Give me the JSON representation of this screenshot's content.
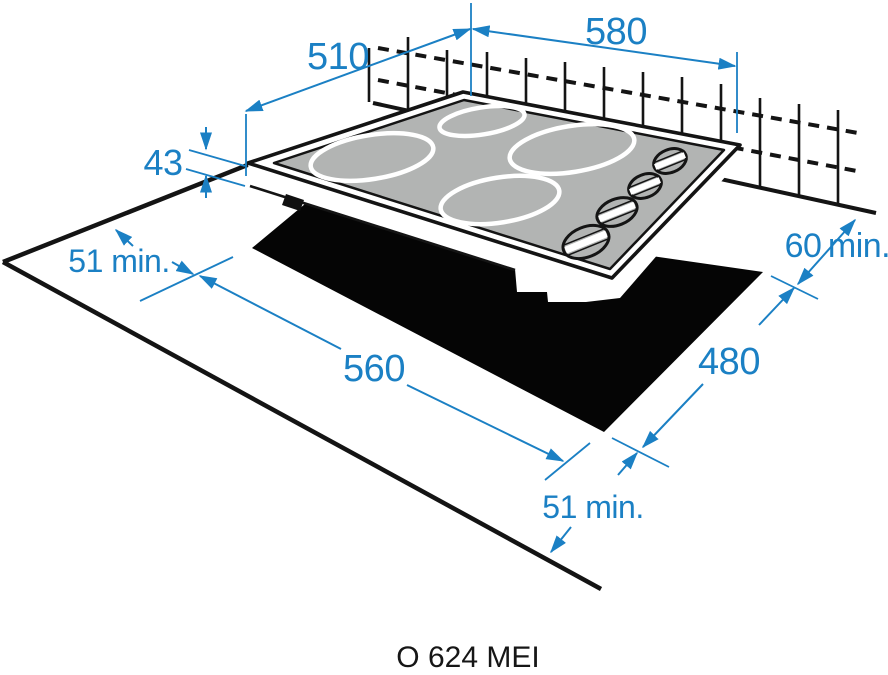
{
  "model": {
    "label": "O 624 MEI"
  },
  "dims": {
    "width": "580",
    "depth": "510",
    "height": "43",
    "left_clearance": "51 min.",
    "rear_clearance_value": "60",
    "rear_clearance_unit": "min.",
    "cutout_width": "560",
    "cutout_depth": "480",
    "front_clearance": "51 min."
  },
  "colors": {
    "dimension_blue": "#1b80c4",
    "glass_gray": "#b2b4b3",
    "cutout_black": "#050505",
    "line_black": "#141414"
  }
}
